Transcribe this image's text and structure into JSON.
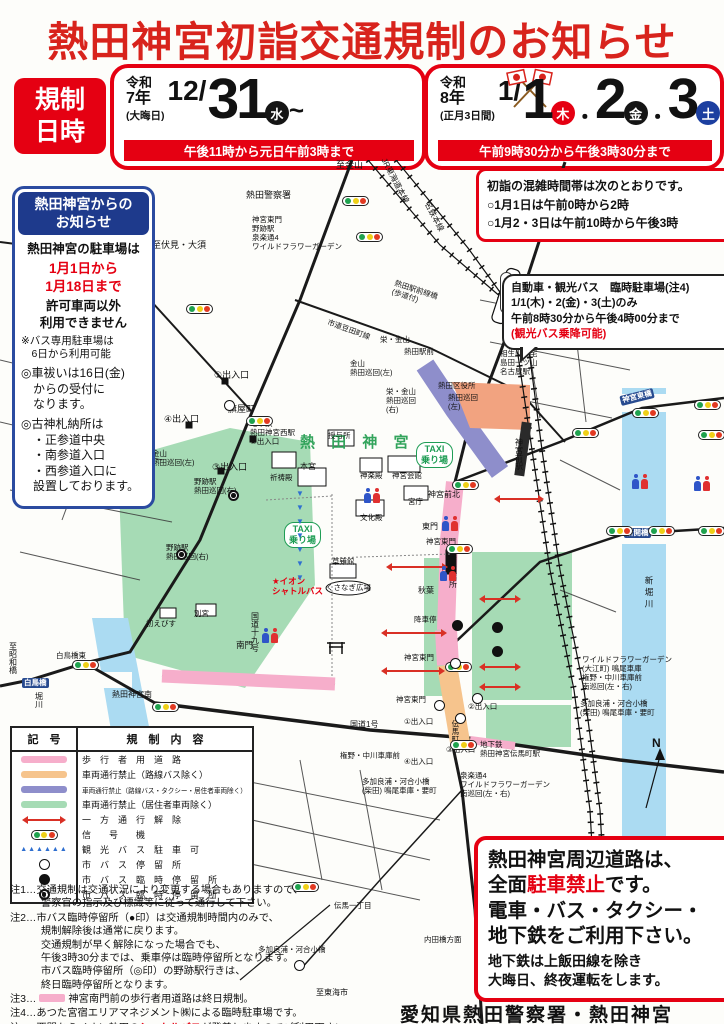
{
  "title": "熱田神宮初詣交通規制のお知らせ",
  "schedule": {
    "label": "規制\n日時",
    "dec": {
      "era1": "令和",
      "era2": "7年",
      "note": "(大晦日)",
      "month": "12/",
      "day": "31",
      "dow": "水",
      "tilde": "~",
      "time": "午後11時から元日午前3時まで"
    },
    "jan": {
      "era1": "令和",
      "era2": "8年",
      "note": "(正月3日間)",
      "month": "1/",
      "d1": "1",
      "d1_dow": "木",
      "sep1": "・",
      "d2": "2",
      "d2_dow": "金",
      "sep2": "・",
      "d3": "3",
      "d3_dow": "土",
      "time": "午前9時30分から午後3時30分まで"
    }
  },
  "congestion_box": {
    "line1": "初詣の混雑時間帯は次のとおりです。",
    "line2": "○1月1日は午前0時から2時",
    "line3": "○1月2・3日は午前10時から午後3時"
  },
  "shrine_notice": {
    "header": "熱田神宮からの\nお知らせ",
    "line1": "熱田神宮の駐車場は",
    "period": "1月1日から\n1月18日まで",
    "line2": "許可車両以外\n利用できません",
    "note": "※バス専用駐車場は\n　6日から利用可能",
    "item1": "◎車祓いは16日(金)\n　からの受付に\n　なります。",
    "item2": "◎古神札納所は\n　・正参道中央\n　・南参道入口\n　・西参道入口に\n　設置しております。"
  },
  "parking_bubble": {
    "line1": "自動車・観光バス　臨時駐車場(注4)",
    "line2": "1/1(木)・2(金)・3(土)のみ",
    "line3": "午前8時30分から午後4時00分まで",
    "line4": "(観光バス乗降可能)"
  },
  "legend": {
    "h1": "記　号",
    "h2": "規　制　内　容",
    "rows": [
      {
        "sym": "pink",
        "label": "歩　行　者　用　道　路"
      },
      {
        "sym": "orange",
        "label": "車両通行禁止（路線バス除く）"
      },
      {
        "sym": "purple",
        "label": "車両通行禁止（路線バス・タクシー・居住者車両除く）",
        "small": true
      },
      {
        "sym": "green",
        "label": "車両通行禁止（居住者車両除く）"
      },
      {
        "sym": "arrow",
        "label": "一　方　通　行　解　除"
      },
      {
        "sym": "signal",
        "label": "信　　号　　機"
      },
      {
        "sym": "tri",
        "label": "観　光　バ　ス　駐　車　可"
      },
      {
        "sym": "stop-white",
        "label": "市　バ　ス　停　留　所"
      },
      {
        "sym": "stop-black",
        "label": "市　バ　ス　臨　時　停　留　所"
      },
      {
        "sym": "stop-ring",
        "label": "市　バ　ス　臨　時　停　留　所"
      }
    ]
  },
  "notes": {
    "n1": "注1…交通規制は交通状況により変更する場合もありますので、\n　　　警察官の指示及び標識等に従って通行して下さい。",
    "n2": "注2…市バス臨時停留所（●印）は交通規制時間内のみで、\n　　　規制解除後は通常に戻ります。\n　　　交通規制が早く解除になった場合でも、\n　　　午後3時30分までは、乗車停は臨時停留所となります。\n　　　市バス臨時停留所（◎印）の野跡駅行きは、\n　　　終日臨時停留所となります。",
    "n3_pre": "注3…",
    "n3_text": "神宮南門前の歩行者用道路は終日規制。",
    "n4": "注4…あつた宮宿エリアマネジメント㈱による臨時駐車場です。",
    "n5_pre": "注5…西門からイオン熱田の",
    "n5_red": "シャトルバス",
    "n5_post": "が発着しますのでご利用下さい。"
  },
  "no_parking_box": {
    "l1": "熱田神宮周辺道路は、",
    "l2a": "全面",
    "l2b": "駐車禁止",
    "l2c": "です。",
    "l3": "電車・バス・タクシー・",
    "l4": "地下鉄をご利用下さい。",
    "l5": "地下鉄は上飯田線を除き\n大晦日、終夜運転をします。"
  },
  "footer": "愛知県熱田警察署・熱田神宮",
  "colors": {
    "accent_red": "#E50012",
    "navy": "#1E3A8C",
    "day_blue": "#1C3FA0",
    "day_black": "#151515",
    "map_green_text": "#33A45C",
    "zone_pink": "#F6AECB",
    "zone_orange": "#F6C48D",
    "zone_purple": "#8E8ECB",
    "zone_green": "#A6DBB5",
    "river": "#ABDBF2",
    "zone_salmon": "#F2A380",
    "signal_green": "#1FA24E",
    "signal_yellow": "#EFD018",
    "signal_red": "#E23A22"
  },
  "map": {
    "labels": [
      {
        "t": "至金山",
        "x": 336,
        "y": 0
      },
      {
        "t": "熱田警察署",
        "x": 246,
        "y": 30
      },
      {
        "t": "神宮東門\n野跡駅\n泉楽通4\nワイルドフラワーガーデン",
        "x": 252,
        "y": 56,
        "s": 7.5
      },
      {
        "t": "至伏見・大須",
        "x": 152,
        "y": 80
      },
      {
        "t": "JR東海道本線",
        "x": 370,
        "y": 16,
        "s": 8,
        "r": 62
      },
      {
        "t": "名鉄本線",
        "x": 418,
        "y": 52,
        "s": 8,
        "r": 62
      },
      {
        "t": "熱田駅前線橋\n(歩道付)",
        "x": 392,
        "y": 126,
        "s": 7.5,
        "r": 18
      },
      {
        "t": "市道豆田町線",
        "x": 326,
        "y": 166,
        "s": 7.5,
        "r": 20
      },
      {
        "t": "栄・金山",
        "x": 380,
        "y": 176,
        "s": 7.5
      },
      {
        "t": "熱田駅前",
        "x": 404,
        "y": 188,
        "s": 7.5
      },
      {
        "t": "金山\n熱田巡回(左)",
        "x": 350,
        "y": 200,
        "s": 7.5
      },
      {
        "t": "あつた駅",
        "x": 500,
        "y": 112,
        "s": 8,
        "v": 1,
        "box": 1
      },
      {
        "t": "①出入口",
        "x": 214,
        "y": 210
      },
      {
        "t": "旗屋町",
        "x": 228,
        "y": 244
      },
      {
        "t": "④出入口",
        "x": 164,
        "y": 254
      },
      {
        "t": "地下鉄\n熱田神宮西駅\n②出入口",
        "x": 250,
        "y": 260,
        "s": 7.5
      },
      {
        "t": "金山\n熱田巡回(左)",
        "x": 152,
        "y": 290,
        "s": 7.5
      },
      {
        "t": "③出入口",
        "x": 212,
        "y": 302
      },
      {
        "t": "野跡駅\n熱田巡回(右)",
        "x": 194,
        "y": 318,
        "s": 7.5
      },
      {
        "t": "野跡駅\n熱田巡回(右)",
        "x": 166,
        "y": 384,
        "s": 7.5
      },
      {
        "t": "熱 田 神 宮",
        "x": 300,
        "y": 274,
        "s": 15,
        "c": "#33A45C",
        "b": 1,
        "sp": 6
      },
      {
        "t": "祈祷殿",
        "x": 270,
        "y": 314,
        "s": 7.5
      },
      {
        "t": "授与所",
        "x": 328,
        "y": 272,
        "s": 7.5
      },
      {
        "t": "神楽殿",
        "x": 360,
        "y": 312,
        "s": 7.5
      },
      {
        "t": "本宮",
        "x": 300,
        "y": 302,
        "s": 8
      },
      {
        "t": "神宮会館",
        "x": 392,
        "y": 312,
        "s": 7.5
      },
      {
        "t": "宮庁",
        "x": 408,
        "y": 338,
        "s": 7.5
      },
      {
        "t": "文化殿",
        "x": 360,
        "y": 354,
        "s": 7.5
      },
      {
        "t": "草薙館",
        "x": 332,
        "y": 398,
        "s": 7.5
      },
      {
        "t": "くさなぎ広場",
        "x": 326,
        "y": 424,
        "s": 7.5
      },
      {
        "t": "警備詰所",
        "x": 448,
        "y": 396,
        "s": 8,
        "v": 1
      },
      {
        "t": "★イオン\nシャトルバス",
        "x": 272,
        "y": 416,
        "s": 8.5,
        "c": "#E50012",
        "b": 1
      },
      {
        "t": "熱田区役所",
        "x": 438,
        "y": 222,
        "s": 7.5
      },
      {
        "t": "熱田巡回\n(左)",
        "x": 448,
        "y": 234,
        "s": 7.5
      },
      {
        "t": "栄・金山\n熱田巡回\n(右)",
        "x": 386,
        "y": 228,
        "s": 7.5
      },
      {
        "t": "神宮前北",
        "x": 428,
        "y": 330,
        "s": 8
      },
      {
        "t": "神宮前駅",
        "x": 514,
        "y": 278,
        "s": 8,
        "v": 1
      },
      {
        "t": "東門",
        "x": 422,
        "y": 362,
        "s": 8
      },
      {
        "t": "神宮東門",
        "x": 426,
        "y": 378,
        "s": 7.5
      },
      {
        "t": "秋葉",
        "x": 418,
        "y": 426,
        "s": 8
      },
      {
        "t": "降車停",
        "x": 414,
        "y": 456,
        "s": 7.5
      },
      {
        "t": "神宮東門",
        "x": 404,
        "y": 494,
        "s": 7.5
      },
      {
        "t": "神宮東門",
        "x": 396,
        "y": 536,
        "s": 7.5
      },
      {
        "t": "①出入口",
        "x": 404,
        "y": 558,
        "s": 7.5
      },
      {
        "t": "②出入口",
        "x": 468,
        "y": 543,
        "s": 7.5
      },
      {
        "t": "③出入口",
        "x": 446,
        "y": 586,
        "s": 7.5
      },
      {
        "t": "④出入口",
        "x": 404,
        "y": 598,
        "s": 7.5
      },
      {
        "t": "地下鉄\n熱田神宮伝馬町駅",
        "x": 480,
        "y": 581,
        "s": 7.5
      },
      {
        "t": "伝馬町",
        "x": 450,
        "y": 560,
        "s": 7.5,
        "v": 1
      },
      {
        "t": "国道1号",
        "x": 350,
        "y": 560,
        "s": 8
      },
      {
        "t": "権野・中川車庫前",
        "x": 340,
        "y": 592,
        "s": 7.5
      },
      {
        "t": "多加良浦・河合小橋\n(柴田) 鳴尾車庫・要町",
        "x": 362,
        "y": 618,
        "s": 7.5
      },
      {
        "t": "泉楽通4\nワイルドフラワーガーデン\n南巡回(左・右)",
        "x": 460,
        "y": 612,
        "s": 7.5
      },
      {
        "t": "国道十九号",
        "x": 250,
        "y": 452,
        "s": 8,
        "v": 1
      },
      {
        "t": "初えびす",
        "x": 146,
        "y": 460,
        "s": 7.5
      },
      {
        "t": "別宮",
        "x": 194,
        "y": 450,
        "s": 7.5
      },
      {
        "t": "南門",
        "x": 236,
        "y": 480,
        "s": 8.5
      },
      {
        "t": "熱田神宮南",
        "x": 112,
        "y": 530,
        "s": 8
      },
      {
        "t": "白鳥橋東",
        "x": 56,
        "y": 492,
        "s": 7.5
      },
      {
        "t": "至昭和橋",
        "x": 8,
        "y": 482,
        "s": 8,
        "v": 1
      },
      {
        "t": "堀川",
        "x": 34,
        "y": 532,
        "s": 8,
        "v": 1
      },
      {
        "t": "白鳥橋",
        "x": 22,
        "y": 518,
        "s": 7.5,
        "bg": "#274A8F"
      },
      {
        "t": "神宮東橋",
        "x": 620,
        "y": 232,
        "s": 7.5,
        "bg": "#274A8F",
        "r": -14
      },
      {
        "t": "新開橋",
        "x": 624,
        "y": 368,
        "s": 7.5,
        "bg": "#274A8F"
      },
      {
        "t": "新堀川",
        "x": 644,
        "y": 416,
        "s": 8.5,
        "v": 1,
        "sp": 3
      },
      {
        "t": "ワイルドフラワーガーデン\n(大江町) 鳴尾車庫\n権野・中川車庫前\n南巡回(左・右)",
        "x": 582,
        "y": 496,
        "s": 7.5
      },
      {
        "t": "多加良浦・河合小橋\n(柴田) 鳴尾車庫・要町",
        "x": 580,
        "y": 540,
        "s": 7.5
      },
      {
        "t": "相生山住宅\n島田一ツ山\n名古屋駅",
        "x": 500,
        "y": 190,
        "s": 7.5
      },
      {
        "t": "伝馬一丁目",
        "x": 334,
        "y": 742,
        "s": 7.5
      },
      {
        "t": "内田橋方面",
        "x": 424,
        "y": 776,
        "s": 7.5
      },
      {
        "t": "多加良浦・河合小橋",
        "x": 258,
        "y": 786,
        "s": 7.5
      },
      {
        "t": "至東海市",
        "x": 316,
        "y": 828,
        "s": 8
      },
      {
        "t": "N",
        "x": 652,
        "y": 576,
        "s": 12,
        "b": 1
      },
      {
        "t": "TAXI\n乗り場",
        "x": 284,
        "y": 362,
        "taxi": 1
      },
      {
        "t": "TAXI\n乗り場",
        "x": 416,
        "y": 282,
        "taxi": 1
      }
    ],
    "signals": [
      [
        342,
        36
      ],
      [
        356,
        72
      ],
      [
        186,
        144
      ],
      [
        246,
        256
      ],
      [
        114,
        268
      ],
      [
        452,
        320
      ],
      [
        446,
        384
      ],
      [
        445,
        502
      ],
      [
        450,
        580
      ],
      [
        152,
        542
      ],
      [
        72,
        500
      ],
      [
        572,
        268
      ],
      [
        632,
        248
      ],
      [
        694,
        240
      ],
      [
        698,
        270
      ],
      [
        606,
        366
      ],
      [
        648,
        366
      ],
      [
        698,
        366
      ],
      [
        292,
        722
      ]
    ],
    "stops": [
      {
        "x": 224,
        "y": 240,
        "k": "w"
      },
      {
        "x": 450,
        "y": 498,
        "k": "w"
      },
      {
        "x": 434,
        "y": 540,
        "k": "w"
      },
      {
        "x": 455,
        "y": 553,
        "k": "w"
      },
      {
        "x": 472,
        "y": 533,
        "k": "w"
      },
      {
        "x": 294,
        "y": 800,
        "k": "w"
      },
      {
        "x": 452,
        "y": 460,
        "k": "b"
      },
      {
        "x": 492,
        "y": 462,
        "k": "b"
      },
      {
        "x": 492,
        "y": 486,
        "k": "b"
      },
      {
        "x": 228,
        "y": 330,
        "k": "r"
      },
      {
        "x": 176,
        "y": 378,
        "k": "r"
      }
    ],
    "arrows": [
      [
        388,
        406,
        58
      ],
      [
        383,
        472,
        62
      ],
      [
        383,
        510,
        60
      ],
      [
        481,
        438,
        38
      ],
      [
        481,
        506,
        38
      ],
      [
        481,
        526,
        38
      ],
      [
        496,
        338,
        46
      ]
    ],
    "chevrons": [
      [
        296,
        330
      ],
      [
        296,
        344
      ],
      [
        296,
        358
      ],
      [
        296,
        372
      ],
      [
        296,
        386
      ],
      [
        296,
        400
      ],
      [
        296,
        414
      ]
    ],
    "persons": [
      [
        364,
        328
      ],
      [
        442,
        356
      ],
      [
        632,
        314
      ],
      [
        694,
        316
      ],
      [
        440,
        406
      ],
      [
        262,
        468
      ]
    ]
  }
}
